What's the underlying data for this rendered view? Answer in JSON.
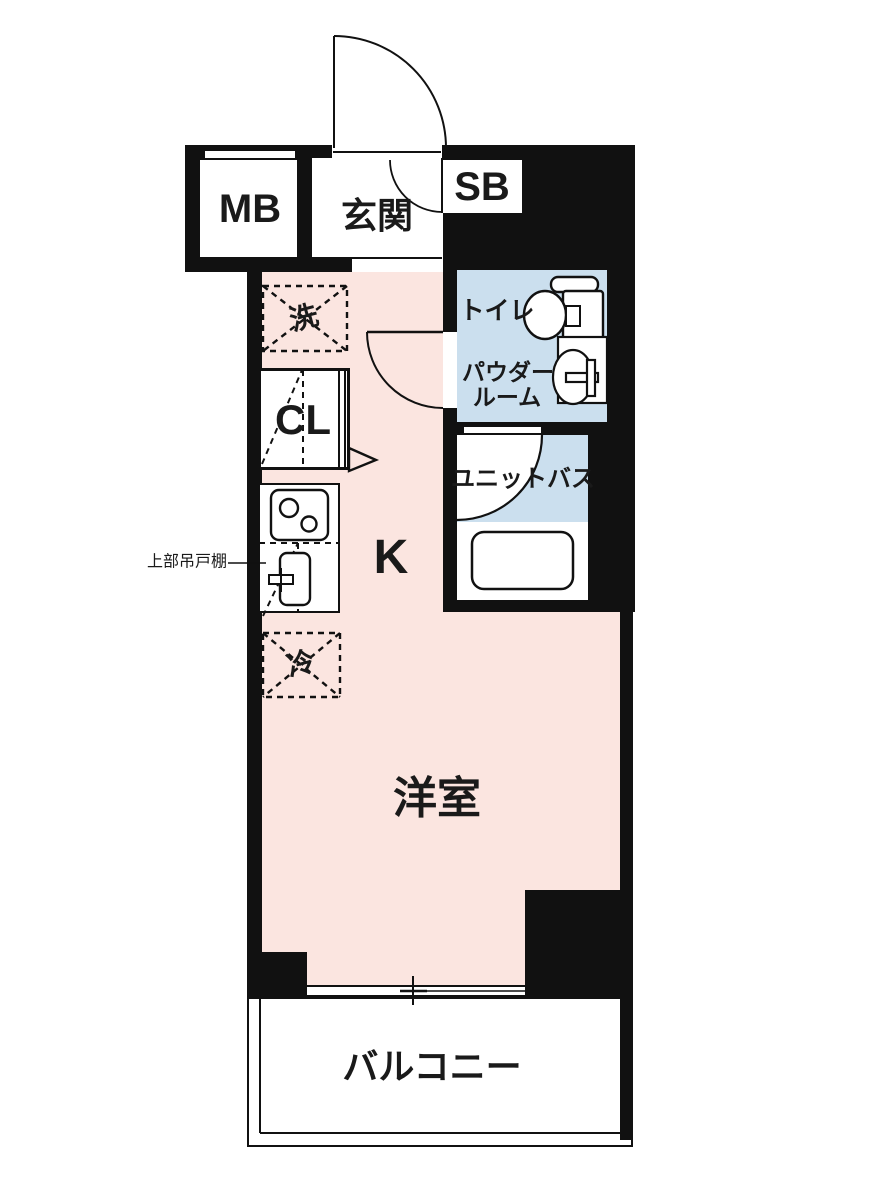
{
  "plan": {
    "labels": {
      "mb": "MB",
      "genkan": "玄関",
      "sb": "SB",
      "washer": "洗",
      "closet": "CL",
      "toilet": "トイレ",
      "powder_line1": "パウダー",
      "powder_line2": "ルーム",
      "unit_bath": "ユニットバス",
      "kitchen": "K",
      "fridge": "冷",
      "western_room": "洋室",
      "balcony": "バルコニー",
      "upper_cabinet_note": "上部吊戸棚"
    },
    "colors": {
      "wall": "#111111",
      "room_pink": "#fbe5e0",
      "wet_area_blue": "#cbdfee",
      "floor_white": "#ffffff",
      "text": "#1a1a1a"
    }
  }
}
